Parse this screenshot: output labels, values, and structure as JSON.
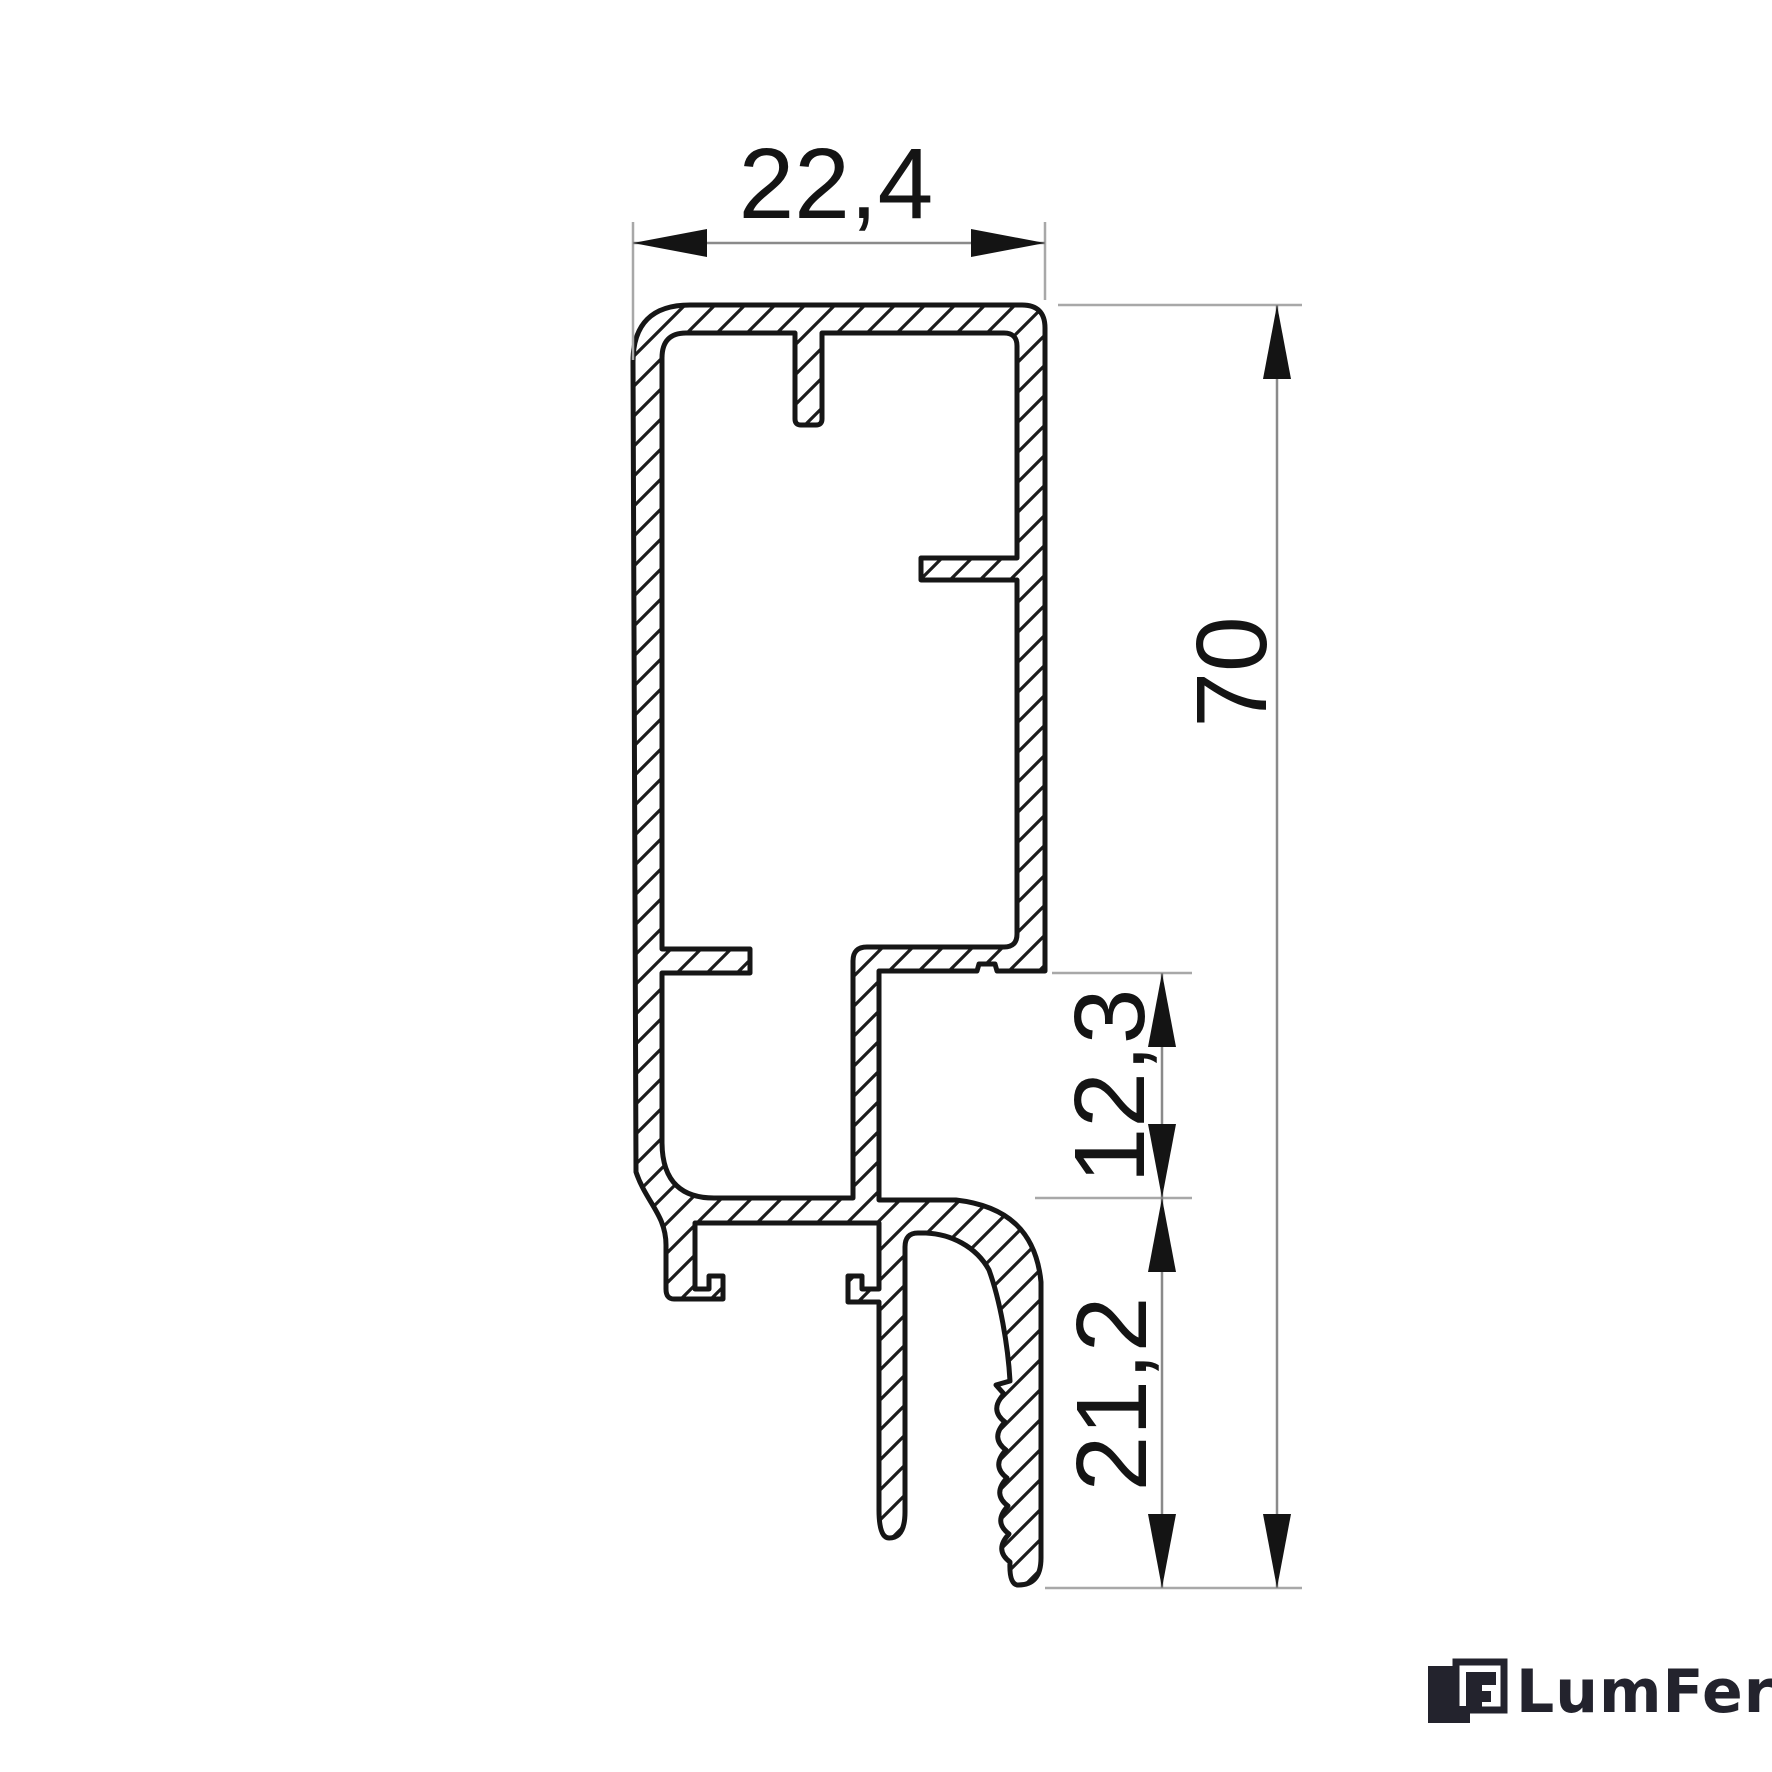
{
  "drawing": {
    "type": "aluminium-profile-cross-section",
    "dimensions": {
      "width": {
        "label": "22,4",
        "value_mm": 22.4,
        "orientation": "horizontal"
      },
      "height": {
        "label": "70",
        "value_mm": 70,
        "orientation": "vertical"
      },
      "step_depth": {
        "label": "12,3",
        "value_mm": 12.3,
        "orientation": "vertical"
      },
      "leg_height": {
        "label": "21,2",
        "value_mm": 21.2,
        "orientation": "vertical"
      }
    },
    "style": {
      "outline_color": "#161616",
      "hatch_color": "#1c1c1c",
      "extension_line_color": "#a8a8a8",
      "dimension_line_color": "#8a8a8a",
      "arrow_color": "#141414",
      "text_color": "#141414",
      "background": "#ffffff"
    }
  },
  "logo": {
    "text": "LumFer",
    "color": "#23232d",
    "icon": "lf-monogram-icon"
  }
}
